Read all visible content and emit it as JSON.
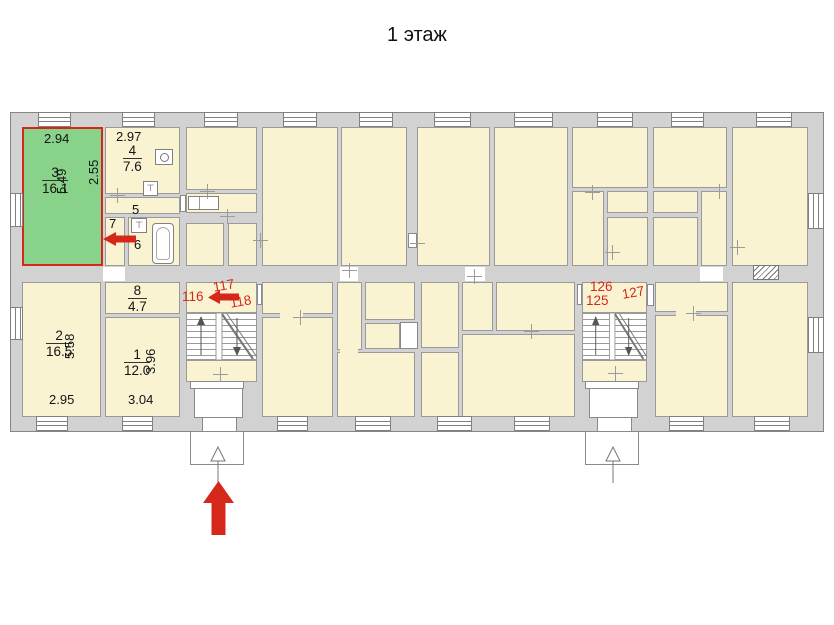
{
  "title": "1 этаж",
  "rooms": {
    "r3": {
      "number": "3",
      "area": "16.1",
      "width": "2.94",
      "height": "5.49"
    },
    "r4": {
      "number": "4",
      "area": "7.6",
      "width": "2.97",
      "height": "2.55"
    },
    "r5": {
      "number": "5"
    },
    "r6": {
      "number": "6"
    },
    "r7": {
      "number": "7"
    },
    "r8": {
      "number": "8",
      "area": "4.7"
    },
    "r1": {
      "number": "1",
      "area": "12.0",
      "width": "3.04",
      "height": "3.96"
    },
    "r2": {
      "number": "2",
      "area": "16.5",
      "width": "2.95",
      "height": "5.58"
    }
  },
  "unit_labels": {
    "u116": "116",
    "u117": "117",
    "u118": "118",
    "u125": "125",
    "u126": "126",
    "u127": "127"
  },
  "colors": {
    "room_fill": "#FAF3D2",
    "wall_fill": "#D2D2D2",
    "wall_line": "#8A8A8A",
    "highlight_fill": "#89D289",
    "highlight_border": "#D6281A",
    "annotation_red": "#D6281A"
  }
}
